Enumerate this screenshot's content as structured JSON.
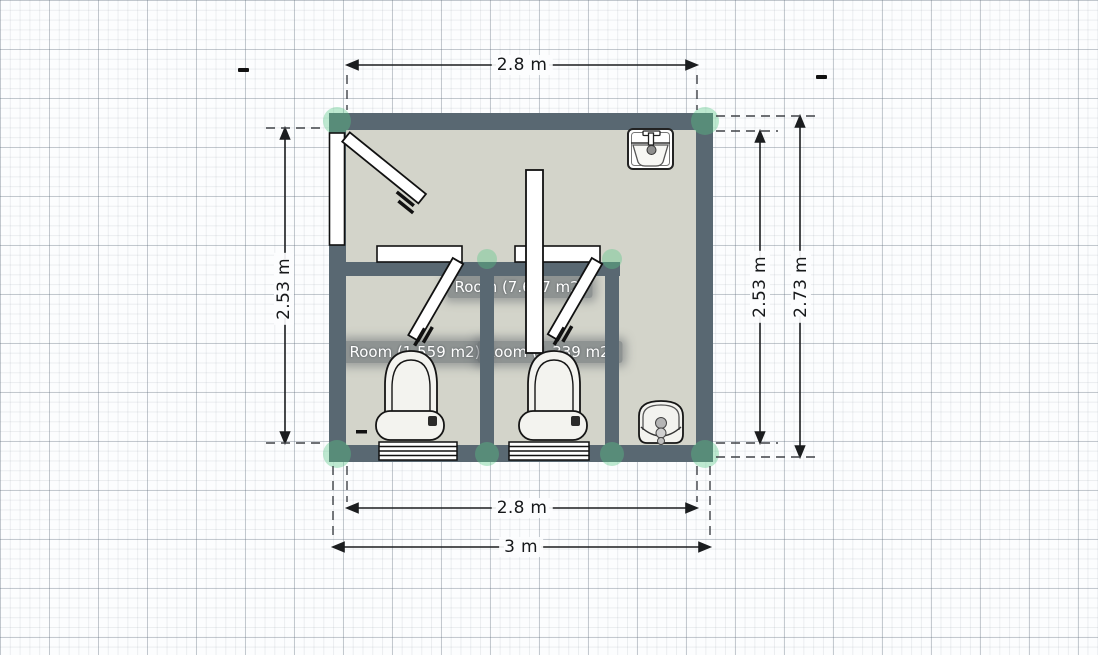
{
  "app": {
    "view": "floor-plan-editor-canvas"
  },
  "colors": {
    "wall": "#596872",
    "floor": "#d3d4ca",
    "joint_handle_green": "#57c785",
    "dimension_ink": "#1b1d1f",
    "fixture_fill": "#f3f3ef",
    "room_label_bg": "rgba(100,106,112,0.62)",
    "room_label_text": "#ffffff"
  },
  "rooms": {
    "main": {
      "label": "Room (7.627 m2)",
      "area_m2": 7.627
    },
    "stall_left": {
      "label": "Room (1.559 m2)",
      "area_m2": 1.559
    },
    "stall_right": {
      "label": "Room (1.339 m2)",
      "area_m2": 1.339
    }
  },
  "dimensions": {
    "top": {
      "label": "2.8 m",
      "value_m": 2.8
    },
    "bottom_inner": {
      "label": "2.8 m",
      "value_m": 2.8
    },
    "bottom_outer": {
      "label": "3 m",
      "value_m": 3.0
    },
    "left": {
      "label": "2.53 m",
      "value_m": 2.53
    },
    "right_inner": {
      "label": "2.53 m",
      "value_m": 2.53
    },
    "right_outer": {
      "label": "2.73 m",
      "value_m": 2.73
    }
  },
  "fixtures": [
    "entrance-door",
    "stall-door-left",
    "stall-door-right",
    "door-leaf-open",
    "toilet-left",
    "toilet-right",
    "wall-hung-toilet",
    "sink",
    "radiator-left",
    "radiator-right"
  ]
}
